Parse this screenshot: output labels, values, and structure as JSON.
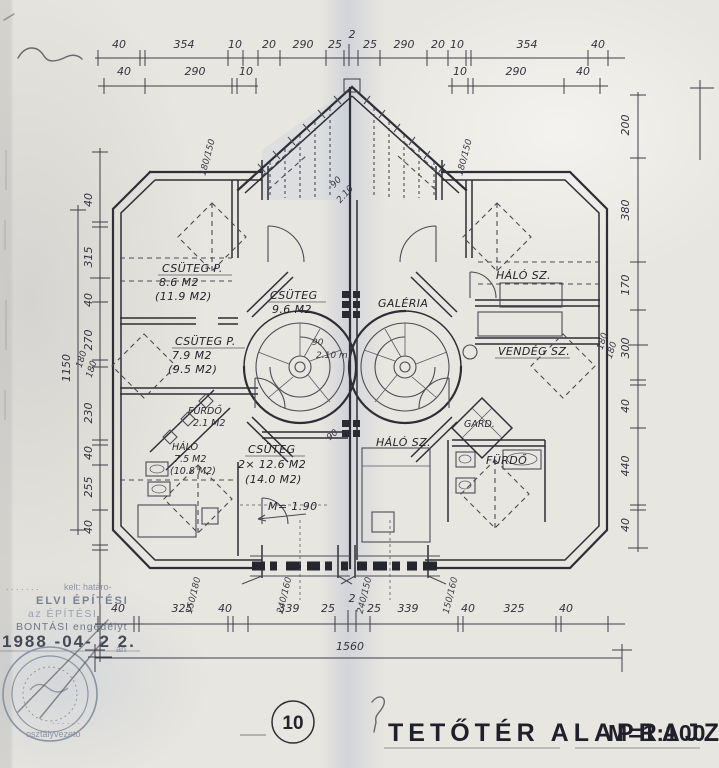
{
  "page": {
    "sheet_number": "10",
    "title": "TETŐTÉR  ALAPRAJZ",
    "scale": "M=1:100"
  },
  "dims": {
    "top_row1": [
      "40",
      "354",
      "10",
      "20",
      "290",
      "25",
      "2",
      "25",
      "290",
      "20",
      "10",
      "354",
      "40"
    ],
    "top_row2_left": [
      "40",
      "290",
      "10"
    ],
    "top_row2_right": [
      "10",
      "290",
      "40"
    ],
    "bottom_row": [
      "40",
      "325",
      "40",
      "339",
      "25",
      "2",
      "25",
      "339",
      "40",
      "325",
      "40"
    ],
    "bottom_total": "1560",
    "left_col": [
      "40",
      "315",
      "40",
      "270",
      "230",
      "40",
      "255",
      "40"
    ],
    "left_total": "1150",
    "left_small": [
      "180",
      "180"
    ],
    "right_col": [
      "200",
      "380",
      "170",
      "300",
      "40",
      "440",
      "40"
    ],
    "right_small": [
      "180",
      "180"
    ]
  },
  "windows": {
    "top_left": "180/150",
    "top_right": "180/150",
    "bottom": [
      "150/180",
      "240/160",
      "240/150",
      "150/160"
    ]
  },
  "doors": {
    "d1_width": "90",
    "d1_height": "2.10",
    "d2_width": "90",
    "d2_height": "2.10 m",
    "d3_width": "90"
  },
  "notes": {
    "headroom": "M= 1.90"
  },
  "rooms": {
    "left": [
      {
        "name": "CSÜTEG P.",
        "area": "8.6 M2",
        "area2": "(11.9 M2)"
      },
      {
        "name": "CSÜTEG",
        "area": "9.6 M2",
        "area2": ""
      },
      {
        "name": "CSÜTEG P.",
        "area": "7.9 M2",
        "area2": "(9.5 M2)"
      },
      {
        "name": "CSÜTEG",
        "area": "2× 12.6 M2",
        "area2": "(14.0 M2)"
      },
      {
        "name": "FÜRDŐ",
        "area": "2.1 M2",
        "area2": ""
      },
      {
        "name": "HÁLÓ",
        "area": "7.5 M2",
        "area2": "(10.8 M2)"
      }
    ],
    "right": [
      {
        "name": "HÁLÓ SZ."
      },
      {
        "name": "VENDÉG SZ."
      },
      {
        "name": "GALÉRIA"
      },
      {
        "name": "HÁLÓ SZ."
      },
      {
        "name": "GARD."
      },
      {
        "name": "FÜRDŐ"
      }
    ]
  },
  "stamp": {
    "dots1": ". . . . . . .",
    "kelt": "kelt: határo-",
    "line1": "ELVI ÉPÍTÉSI",
    "line2": "az ÉPÍTÉSI",
    "line3": "BONTÁSI engedélyt",
    "date": "1988 -04- 2 2.",
    "date_suffix": "án",
    "dots2": ". . . . . .",
    "signer": "osztályvezető"
  }
}
